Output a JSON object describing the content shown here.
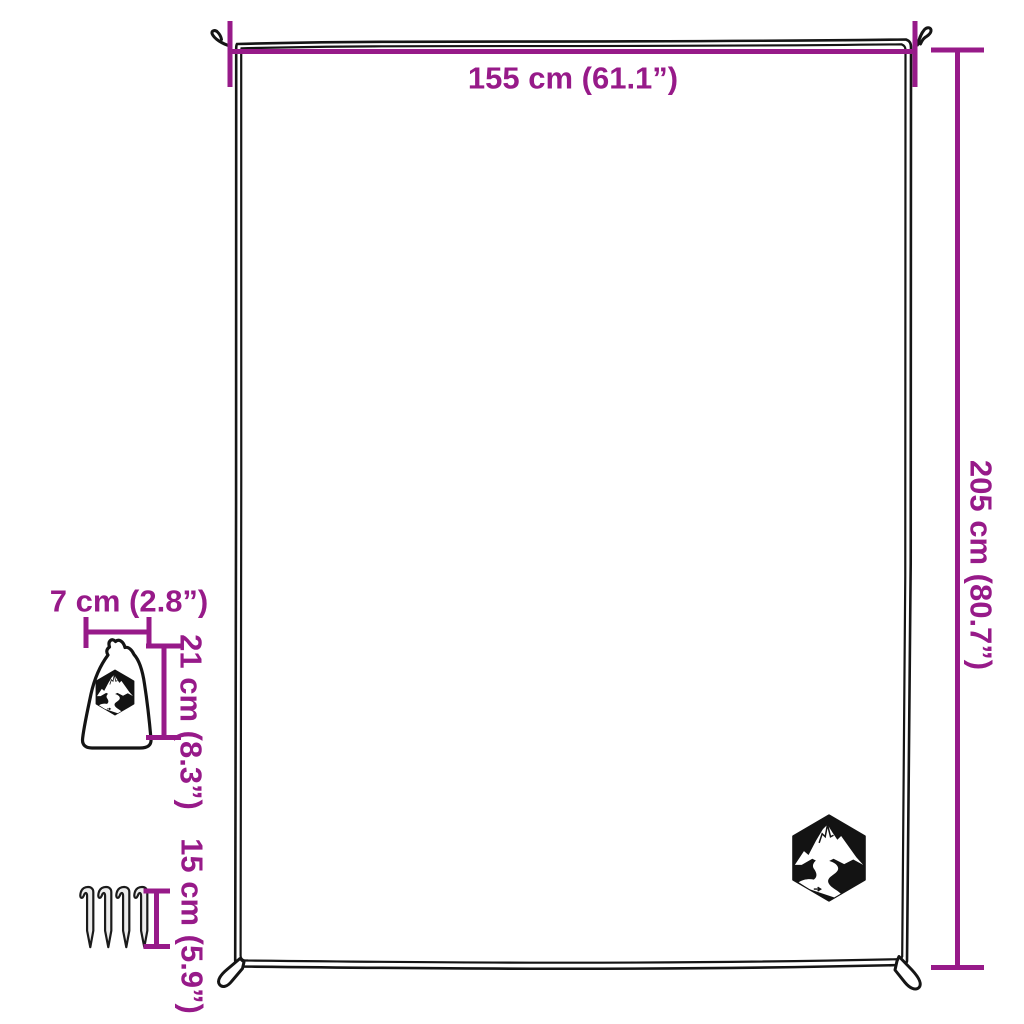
{
  "diagram": {
    "description": "product-dimension-diagram-picnic-blanket",
    "accent_color": "#971a89",
    "line_color": "#151515",
    "background_color": "#ffffff",
    "blanket": {
      "width_label": "155 cm (61.1”)",
      "height_label": "205 cm (80.7”)",
      "logo": "mountain-river-hexagon-logo"
    },
    "storage_bag": {
      "width_label": "7 cm (2.8”)",
      "height_label": "21 cm (8.3”)",
      "logo": "mountain-river-hexagon-logo"
    },
    "pegs": {
      "count": 4,
      "height_label": "15 cm (5.9”)"
    }
  }
}
